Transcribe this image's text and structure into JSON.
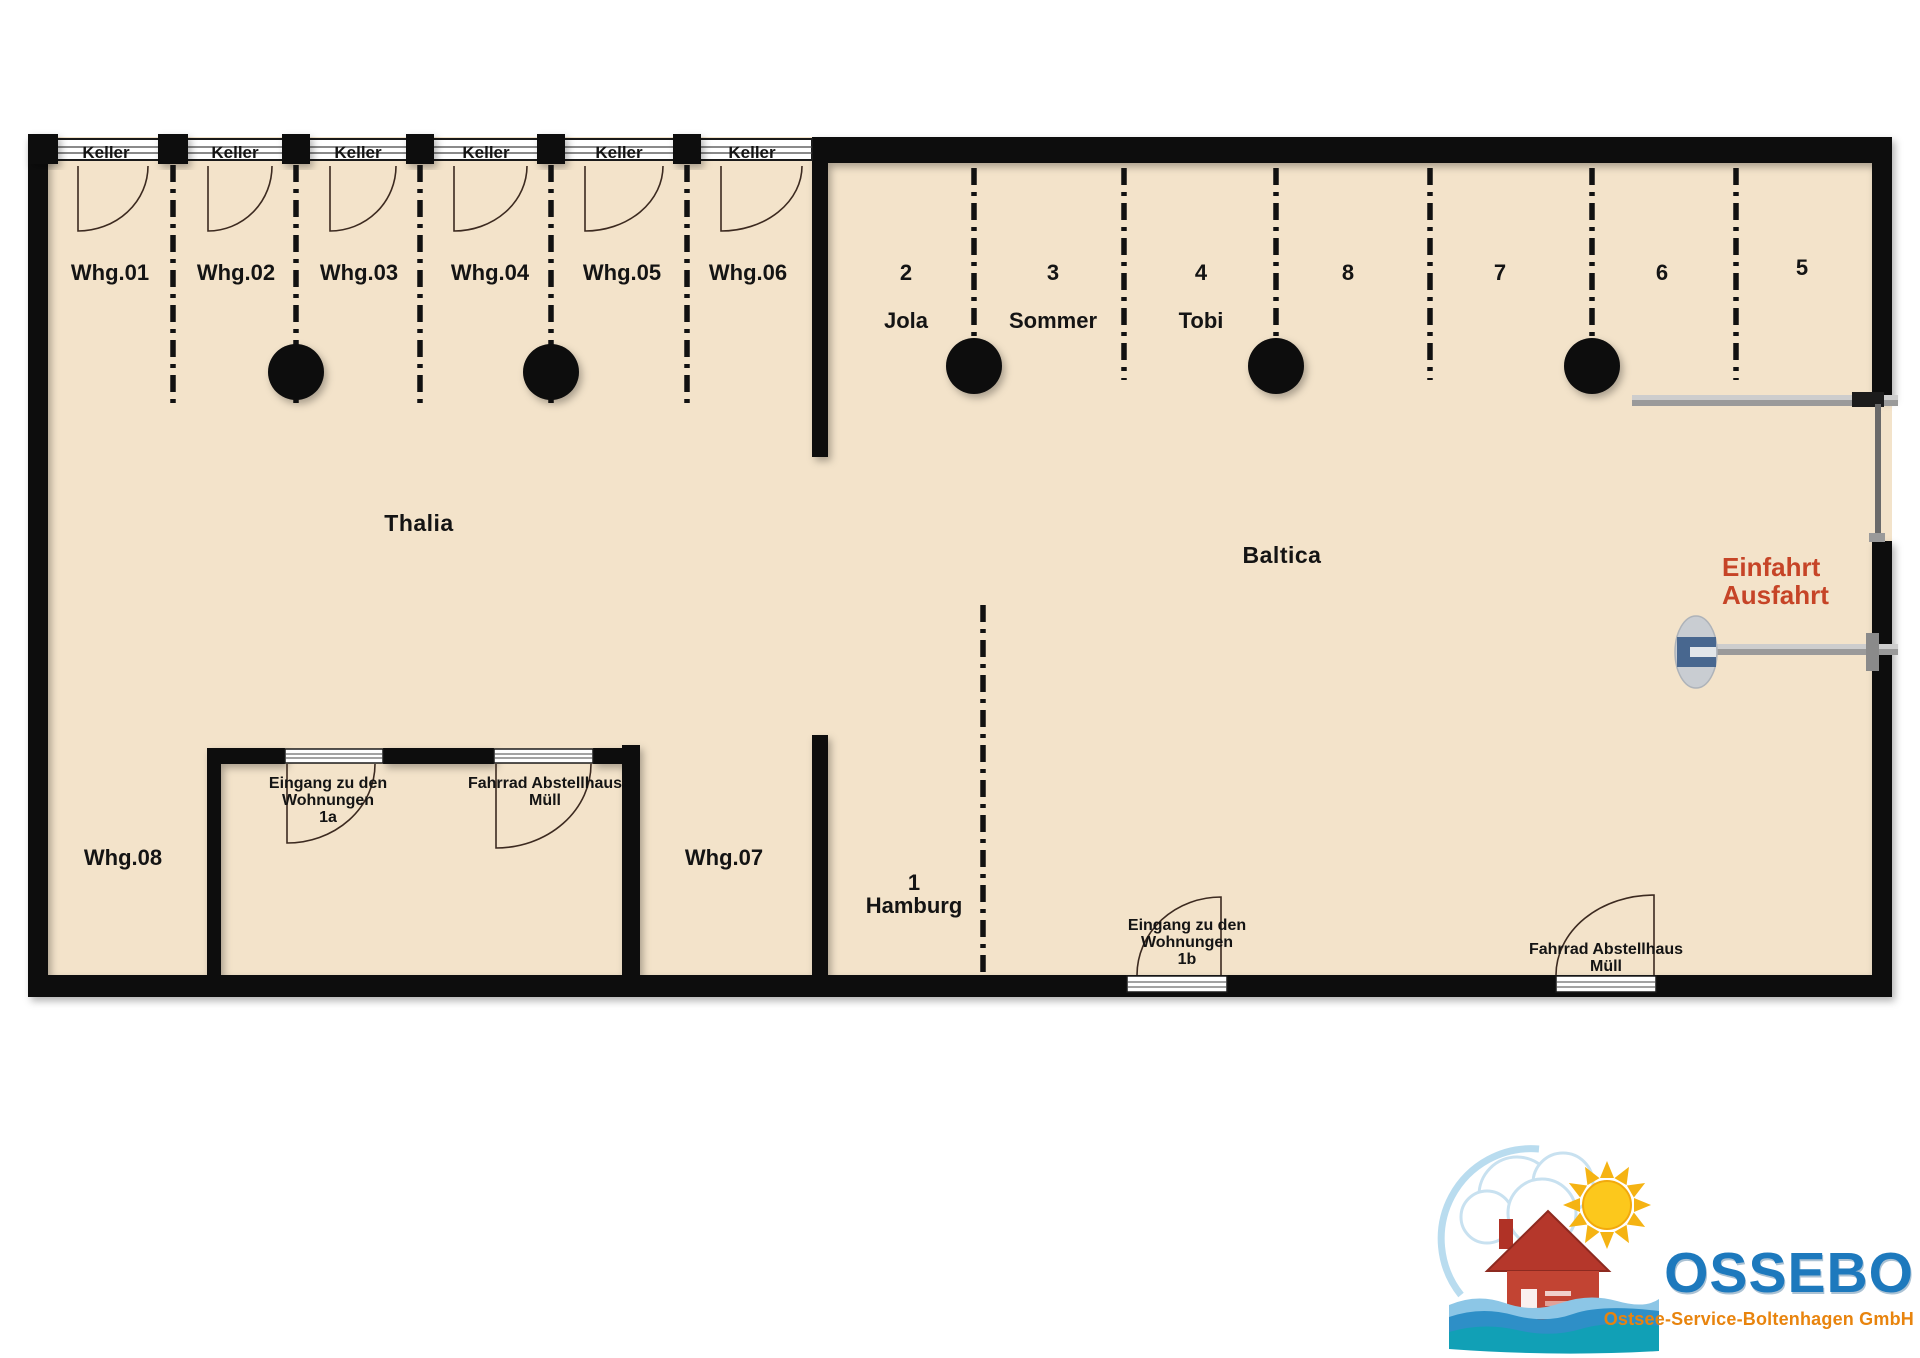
{
  "plan": {
    "colors": {
      "floor": "#f3e3ca",
      "wall": "#0d0d0d",
      "gate_text": "#c64427",
      "barrier_blue": "#48678f",
      "bar_gray": "#9a9a9a"
    },
    "halls": {
      "left": "Thalia",
      "right": "Baltica"
    },
    "keller": [
      "Keller",
      "Keller",
      "Keller",
      "Keller",
      "Keller",
      "Keller"
    ],
    "apartments_top": [
      "Whg.01",
      "Whg.02",
      "Whg.03",
      "Whg.04",
      "Whg.05",
      "Whg.06"
    ],
    "apartment_07": "Whg.07",
    "apartment_08": "Whg.08",
    "parking": [
      {
        "number": "2",
        "name": "Jola"
      },
      {
        "number": "3",
        "name": "Sommer"
      },
      {
        "number": "4",
        "name": "Tobi"
      },
      {
        "number": "8",
        "name": ""
      },
      {
        "number": "7",
        "name": ""
      },
      {
        "number": "6",
        "name": ""
      },
      {
        "number": "5",
        "name": ""
      }
    ],
    "parking_hamburg": {
      "number": "1",
      "name": "Hamburg"
    },
    "entrance_1a": "Eingang zu den\nWohnungen\n1a",
    "bike_house_left": "Fahrrad Abstellhaus\nMüll",
    "entrance_1b": "Eingang zu den\nWohnungen\n1b",
    "bike_house_right": "Fahrrad Abstellhaus\nMüll",
    "gate_label": "Einfahrt\nAusfahrt"
  },
  "logo": {
    "name": "OSSEBO",
    "subtitle": "Ostsee-Service-Boltenhagen GmbH"
  }
}
